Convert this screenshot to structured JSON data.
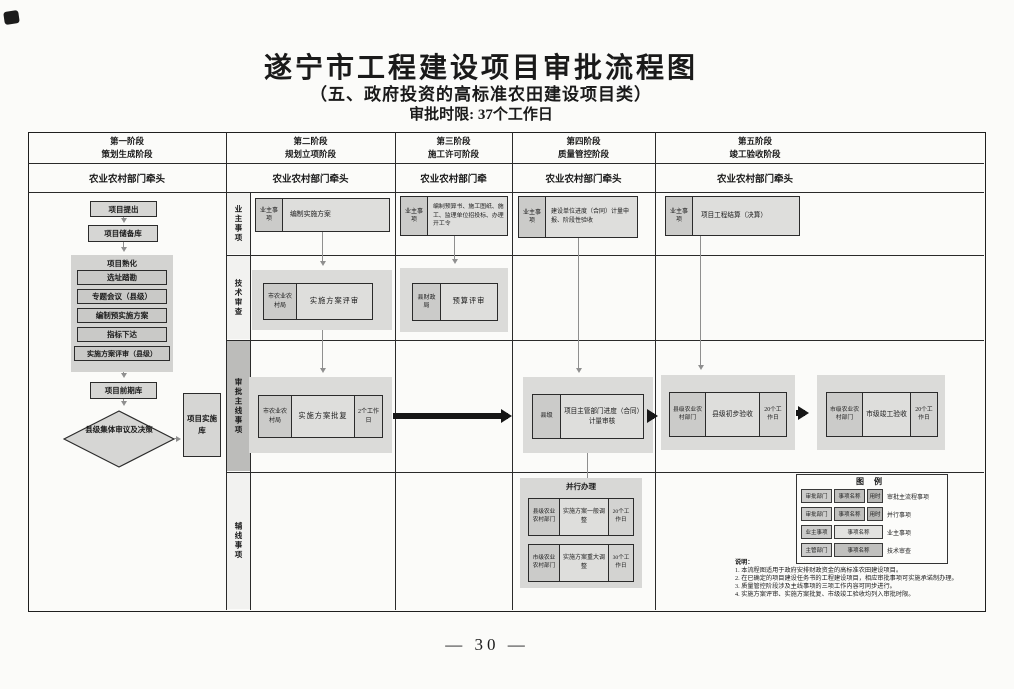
{
  "page": {
    "title": "遂宁市工程建设项目审批流程图",
    "subtitle": "（五、政府投资的高标准农田建设项目类）",
    "time_limit": "审批时限: 37个工作日",
    "page_number": "— 30 —"
  },
  "stages": [
    {
      "line1": "第一阶段",
      "line2": "策划生成阶段",
      "lead": "农业农村部门牵头"
    },
    {
      "line1": "第二阶段",
      "line2": "规划立项阶段",
      "lead": "农业农村部门牵头"
    },
    {
      "line1": "第三阶段",
      "line2": "施工许可阶段",
      "lead": "农业农村部门牵"
    },
    {
      "line1": "第四阶段",
      "line2": "质量管控阶段",
      "lead": "农业农村部门牵头"
    },
    {
      "line1": "第五阶段",
      "line2": "竣工验收阶段",
      "lead": "农业农村部门牵头"
    }
  ],
  "rows": {
    "r1": "业主事项",
    "r2": "技术审查",
    "r3": "审批主线事项",
    "r4": "辅线事项"
  },
  "s1": {
    "box1": "项目提出",
    "box2": "项目储备库",
    "group_title": "项目熟化",
    "g1": "选址踏勘",
    "g2": "专题会议（县级）",
    "g3": "编制预实施方案",
    "g4": "指标下达",
    "g5": "实施方案评审（县级）",
    "box3": "项目前期库",
    "diamond": "县级集体审议及决策",
    "impl": "项目实施库"
  },
  "s2": {
    "owner_dept": "业主事项",
    "owner_name": "编制实施方案",
    "tech_dept": "市农业农村局",
    "tech_name": "实施方案评审",
    "main_dept": "市农业农村局",
    "main_name": "实施方案批复",
    "main_time": "2个工作日"
  },
  "s3": {
    "owner_dept": "业主事项",
    "owner_name": "编制预算书、施工图纸、施工、监理单位招投标、办理开工令",
    "tech_dept": "县财政局",
    "tech_name": "预算评审"
  },
  "s4": {
    "owner_dept": "业主事项",
    "owner_name": "建设单位进度（合同）计量申报、阶段性验收",
    "main_dept": "县级",
    "main_name": "项目主管部门进度（合同）计量审核",
    "parallel_title": "并行办理",
    "p1_dept": "县级农业农村部门",
    "p1_name": "实施方案一般调整",
    "p1_time": "20个工作日",
    "p2_dept": "市级农业农村部门",
    "p2_name": "实施方案重大调整",
    "p2_time": "30个工作日"
  },
  "s5": {
    "owner_dept": "业主事项",
    "owner_name": "项目工程结算（决算）",
    "m1_dept": "县级农业农村部门",
    "m1_name": "县级初步验收",
    "m1_time": "20个工作日",
    "m2_dept": "市级农业农村部门",
    "m2_name": "市级竣工验收",
    "m2_time": "20个工作日"
  },
  "legend": {
    "title": "图 例",
    "r1c1": "审批部门",
    "r1c2": "事项名称",
    "r1c3": "用时",
    "r1d": "审批主流程事项",
    "r2c1": "审批部门",
    "r2c2": "事项名称",
    "r2c3": "用时",
    "r2d": "并行事项",
    "r3c1": "业主事项",
    "r3c2": "事项名称",
    "r3d": "业主事项",
    "r4c1": "主管部门",
    "r4c2": "事项名称",
    "r4d": "技术审查"
  },
  "notes": {
    "title": "说明：",
    "n1": "1. 本流程图适用于政府安排财政资金的高标准农田建设项目。",
    "n2": "2. 在已确定的项目建设任务书的工程建设项目，相应审批事项可实施承诺制办理。",
    "n3": "3. 质量管控阶段涉及主线事项的三项工作内容可同步进行。",
    "n4": "4. 实施方案评审、实施方案批复、市级竣工验收均列入审批时限。"
  },
  "colors": {
    "box_fill": "#d6d6d4",
    "strip_highlight": "#bcbcba",
    "fat_arrow": "#161616",
    "thin_arrow": "#8f8f8f"
  }
}
